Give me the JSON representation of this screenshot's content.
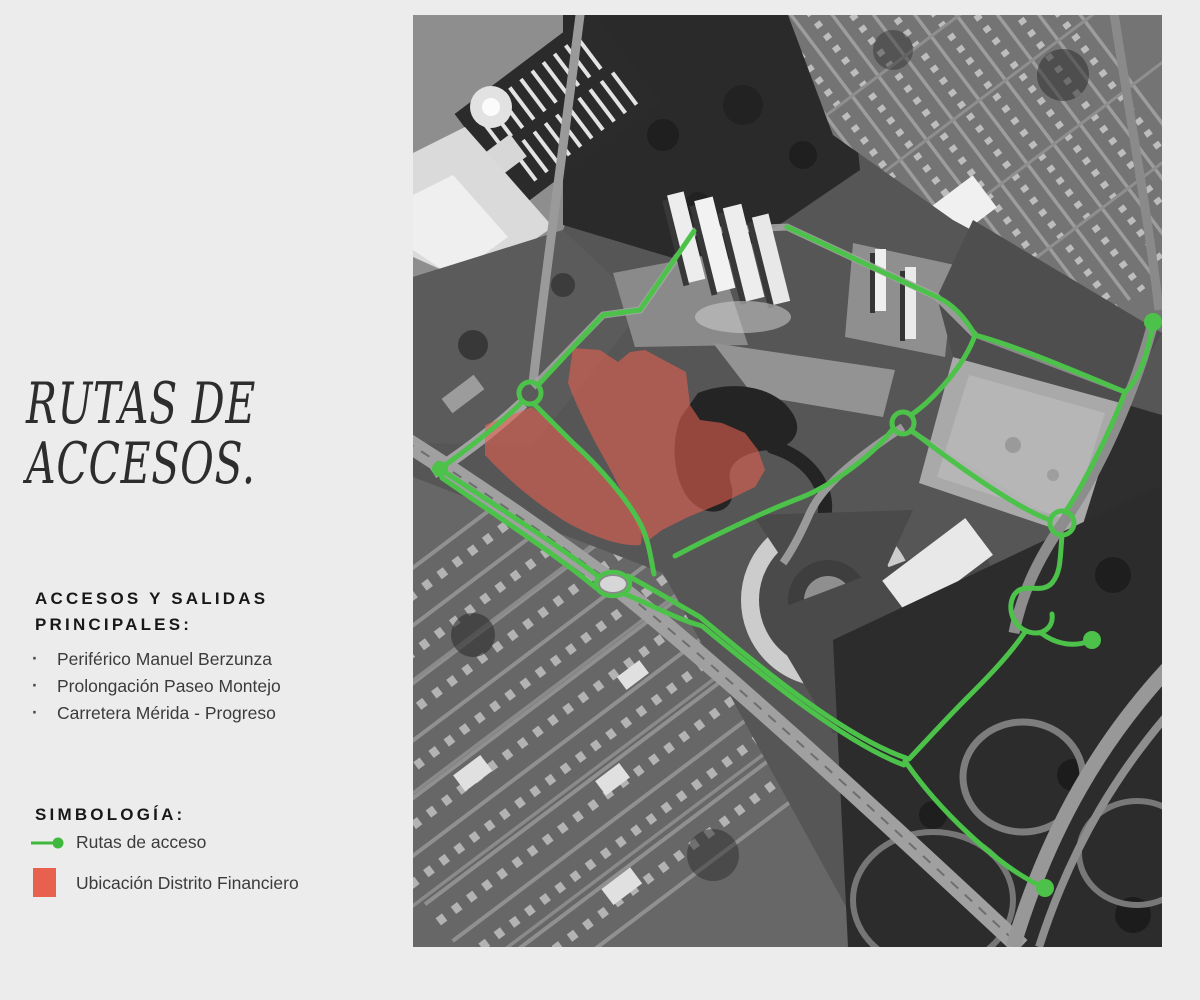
{
  "theme": {
    "route_green": "#4CC24A",
    "district_red": "#E8614F",
    "page_bg": "#ECECEC"
  },
  "left_panel": {
    "title": {
      "lines": [
        "RUTAS DE",
        "ACCESOS."
      ]
    },
    "accesos": {
      "heading": "ACCESOS Y SALIDAS PRINCIPALES:",
      "items": [
        "Periférico Manuel Berzunza",
        "Prolongación Paseo Montejo",
        "Carretera Mérida - Progreso"
      ]
    },
    "simbologia": {
      "heading": "SIMBOLOGÍA:",
      "legend": [
        {
          "icon": "route-arrow-icon",
          "label": "Rutas de acceso",
          "color": "#3FB93D"
        },
        {
          "icon": "location-square-icon",
          "label": "Ubicación Distrito Financiero",
          "color": "#E8614F"
        }
      ]
    }
  }
}
